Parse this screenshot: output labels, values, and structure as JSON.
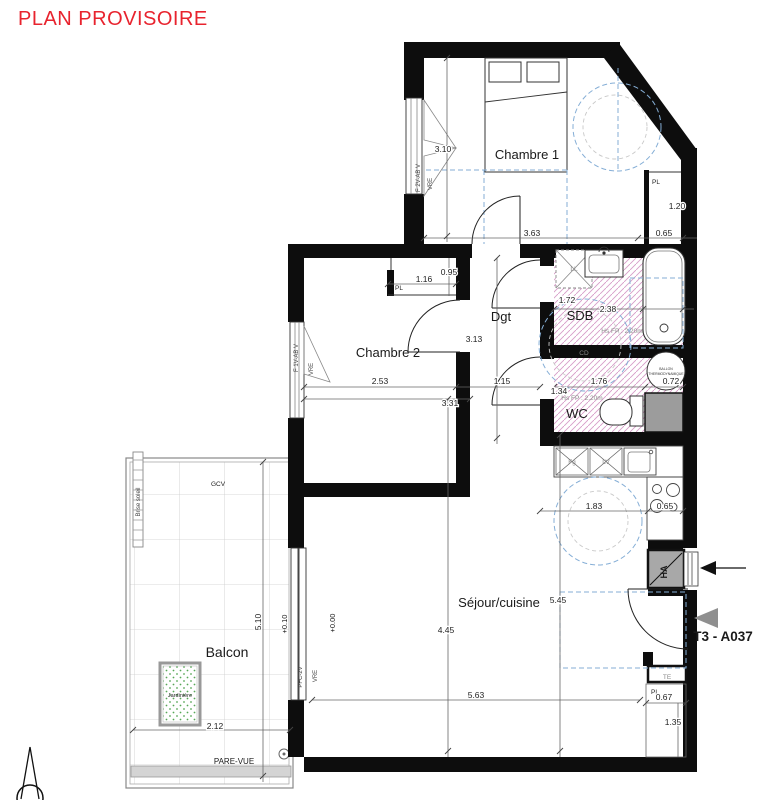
{
  "title": "PLAN PROVISOIRE",
  "unit": {
    "label": "T3 - A037"
  },
  "rooms": {
    "chambre1": "Chambre 1",
    "chambre2": "Chambre 2",
    "dgt": "Dgt",
    "sdb": "SDB",
    "wc": "WC",
    "sejour": "Séjour/cuisine",
    "balcon": "Balcon"
  },
  "dims": {
    "c1_h": "3.10",
    "c1_w": "3.63",
    "c1_pl_w": "0.65",
    "c1_pl_h": "1.20",
    "c2_pl_w": "1.16",
    "c2_pl_h": "0.95",
    "dgt_h": "3.13",
    "c2_w": "2.53",
    "c2_w_tot": "3.31",
    "dgt_w": "1.15",
    "sdb_w1": "1.72",
    "sdb_w2": "2.38",
    "wc_w": "1.76",
    "ballon_w": "0.72",
    "wc_h": "1.34",
    "kit_w": "1.83",
    "kit_w2": "0.65",
    "sej_h1": "5.45",
    "sej_h2": "4.45",
    "sej_w": "5.63",
    "ent_pl_w": "0.67",
    "ent_pl_h": "1.35",
    "balc_w": "2.12",
    "balc_h": "5.10"
  },
  "levels": {
    "sejour": "+0.00",
    "balcon": "+0.10"
  },
  "closets": {
    "c1": "PL",
    "c2": "PL",
    "entree": "PL"
  },
  "equipment": {
    "ballon1": "BALLON",
    "ballon2": "THERMODYNAMIQUE",
    "ll": "LL",
    "fg": "Fg",
    "lv": "LV",
    "te": "TE",
    "ha": "HA",
    "cd": "CD",
    "gcv": "GCV"
  },
  "annotations": {
    "hsfp_sdb": "Hs FP : 2.20m",
    "hsfp_wc": "Hs FP : 2.20m",
    "pare_vue": "PARE-VUE",
    "brise_soleil": "Brise soleil",
    "jardiniere": "Jardinière"
  },
  "openings": {
    "c1_window": "F 2V-AB V",
    "c1_vre": "VRE",
    "c2_window": "F 1V-AB V",
    "c2_vre": "VRE",
    "balcony_door": "PFC-2V",
    "balcony_vre": "VRE"
  },
  "colors": {
    "accent_red": "#e8232e",
    "wall_black": "#0d0d0d",
    "hatch_pink": "#d79cc8",
    "dash_blue": "#85aed6",
    "jardiniere_green": "#57a757"
  }
}
